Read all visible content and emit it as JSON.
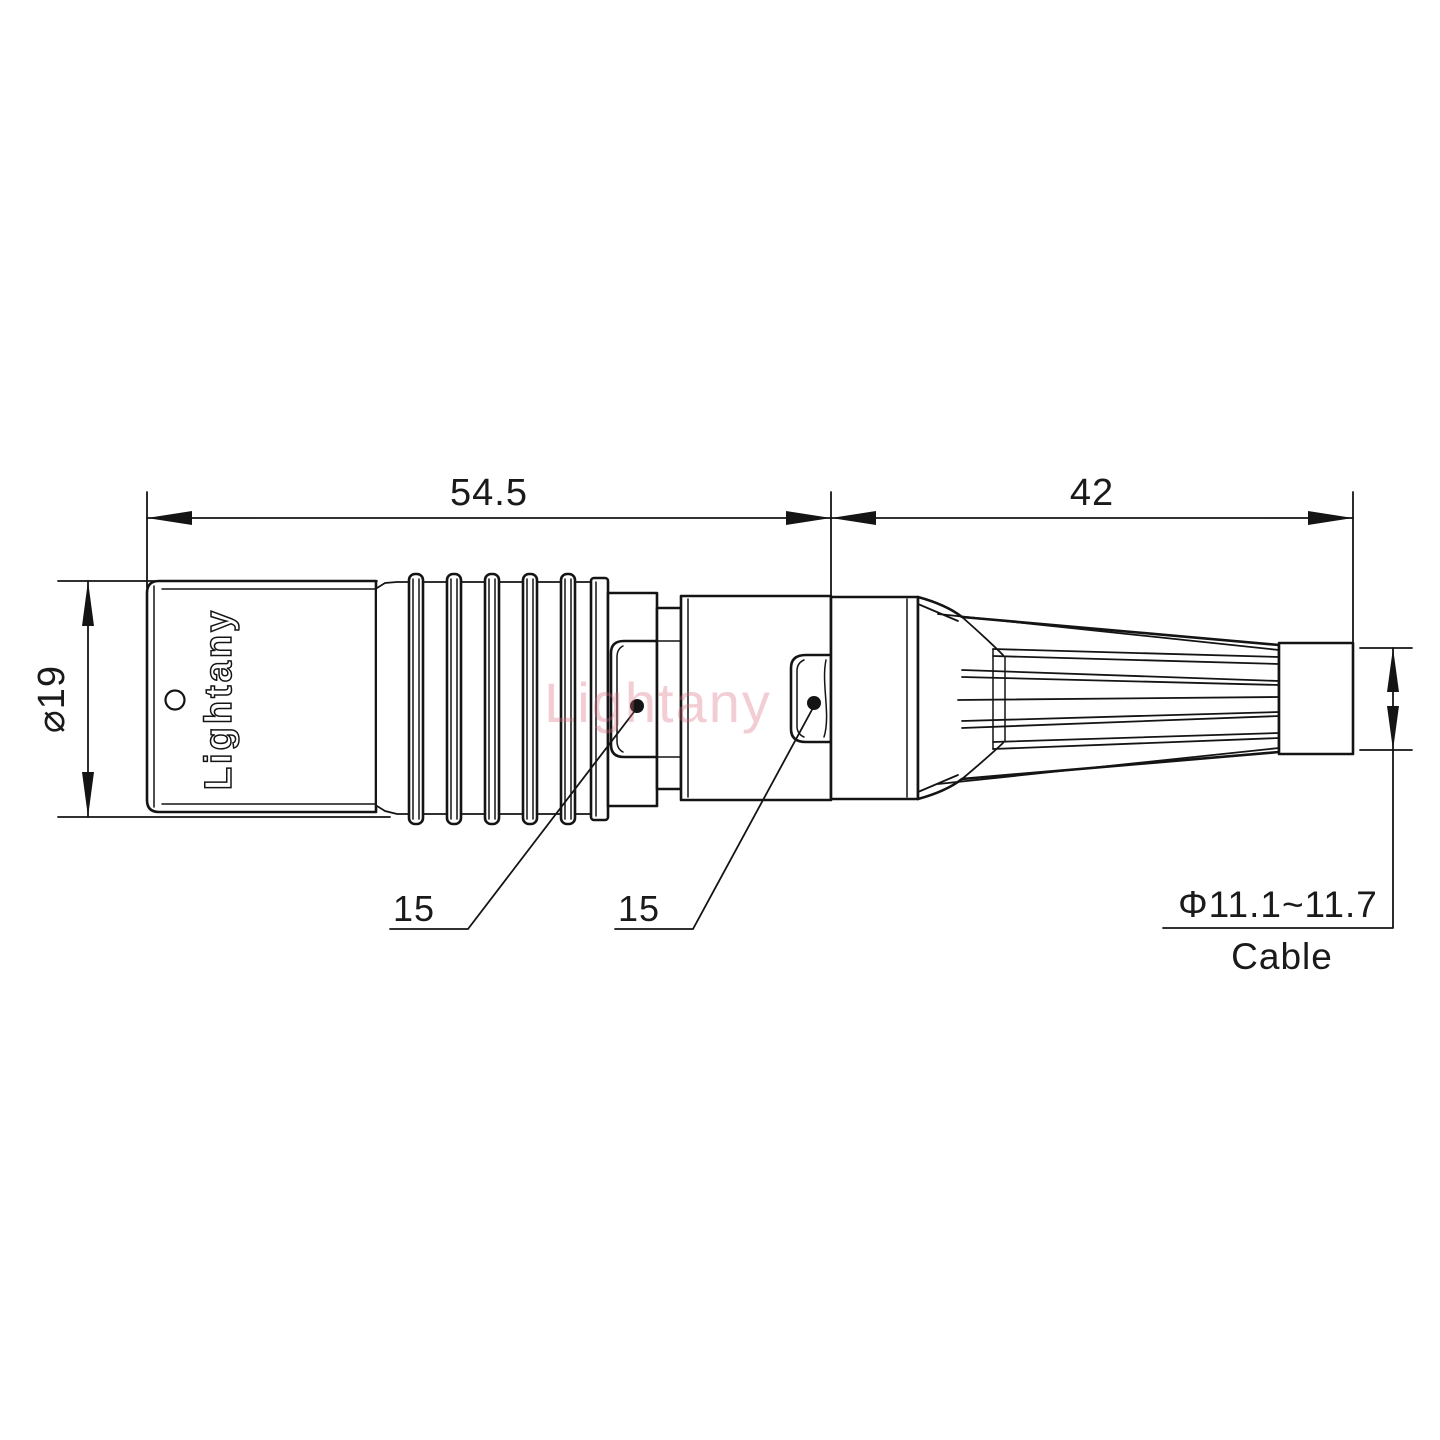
{
  "drawing": {
    "type": "engineering-dimension-drawing",
    "subject": "circular push-pull connector with bend relief, side view",
    "background_color": "#ffffff",
    "line_color": "#141414",
    "watermark": {
      "text": "Lightany",
      "color": "#d96a7f"
    },
    "body_marking": {
      "text": "Lightany"
    },
    "dimensions": {
      "body_length": {
        "value": "54.5"
      },
      "relief_length": {
        "value": "42"
      },
      "body_diameter": {
        "value": "⌀19"
      },
      "leader_left": {
        "value": "15"
      },
      "leader_right": {
        "value": "15"
      },
      "cable_diameter": {
        "value": "Φ11.1~11.7"
      },
      "cable_label": {
        "value": "Cable"
      }
    }
  }
}
